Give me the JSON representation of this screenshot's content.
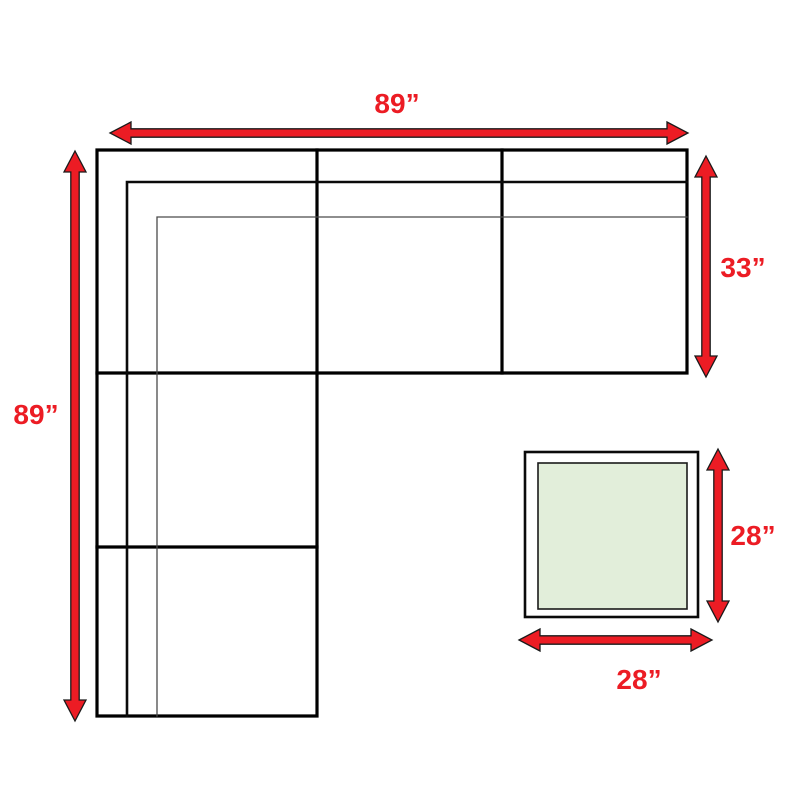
{
  "diagram": {
    "type": "furniture-dimension-diagram",
    "items": [
      "sectional-sofa",
      "ottoman"
    ],
    "labels": {
      "sofa_width_top": "89”",
      "sofa_length_left": "89”",
      "section_depth_right": "33”",
      "ottoman_depth_right": "28”",
      "ottoman_width_bottom": "28”"
    },
    "measurements": {
      "sofa_width_inches": 89,
      "sofa_length_inches": 89,
      "section_depth_inches": 33,
      "ottoman_depth_inches": 28,
      "ottoman_width_inches": 28
    },
    "colors": {
      "arrow_red": "#ec1c24",
      "label_red": "#ec1c24",
      "line_black": "#000000",
      "ottoman_cushion_green": "#e2eeda",
      "background": "#ffffff",
      "fill_white": "#ffffff"
    }
  }
}
